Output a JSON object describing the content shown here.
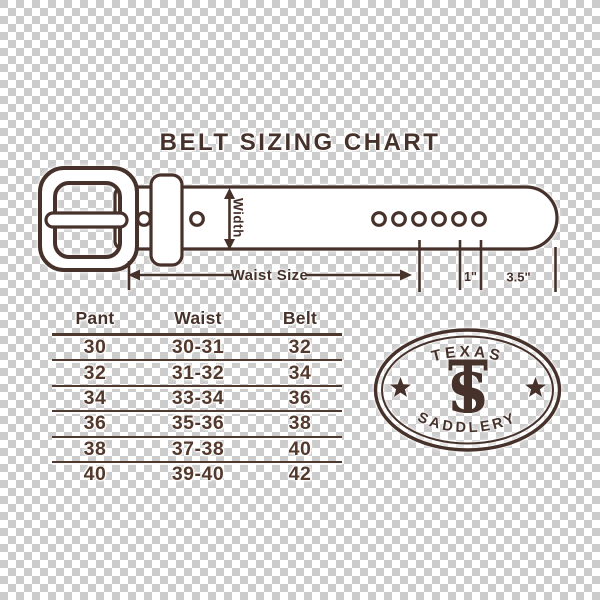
{
  "title": "BELT SIZING CHART",
  "belt_diagram": {
    "width_label": "Width",
    "waist_size_label": "Waist Size",
    "hole_spacing_label": "1\"",
    "tip_length_label": "3.5\""
  },
  "sizing_table": {
    "headers": [
      "Pant",
      "Waist",
      "Belt"
    ],
    "rows": [
      [
        "30",
        "30-31",
        "32"
      ],
      [
        "32",
        "31-32",
        "34"
      ],
      [
        "34",
        "33-34",
        "36"
      ],
      [
        "36",
        "35-36",
        "38"
      ],
      [
        "38",
        "37-38",
        "40"
      ],
      [
        "40",
        "39-40",
        "42"
      ]
    ]
  },
  "logo": {
    "arc_top": "TEXAS",
    "arc_bottom": "SADDLERY",
    "monogram": "S"
  },
  "colors": {
    "ink": "#46322A",
    "belt_fill": "#FFFFFF",
    "checker_light": "#FFFFFF",
    "checker_dark": "#CCCCCC"
  }
}
